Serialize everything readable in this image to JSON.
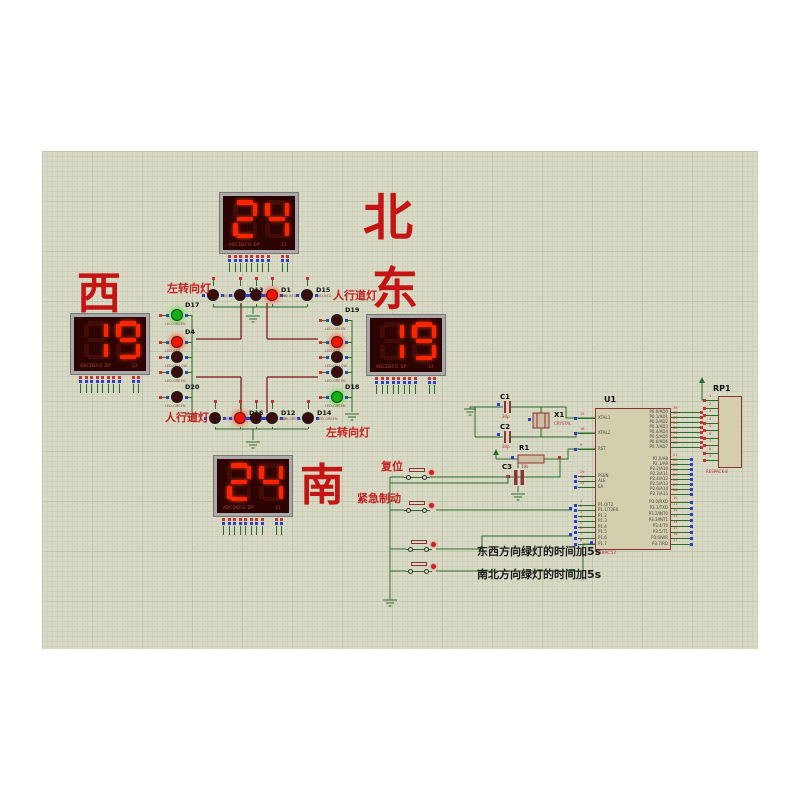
{
  "app": {
    "canvas_bg": "#d9dac6",
    "wire_color": "#2a6e2a",
    "road_color": "#8b3434",
    "accent_red": "#c41414"
  },
  "displays": [
    {
      "name": "north",
      "digits": "24",
      "char": "北",
      "strip_left": "ABCDEFG  DP",
      "strip_right": "12",
      "x": 220,
      "y": 193,
      "char_x": 363,
      "char_y": 193,
      "char_size": 50
    },
    {
      "name": "west",
      "digits": "19",
      "char": "西",
      "strip_left": "ABCDEFG  DP",
      "strip_right": "12",
      "x": 71,
      "y": 314,
      "char_x": 77,
      "char_y": 272,
      "char_size": 44
    },
    {
      "name": "east",
      "digits": "19",
      "char": "东",
      "strip_left": "ABCDEFG  DP",
      "strip_right": "12",
      "x": 367,
      "y": 315,
      "char_x": 372,
      "char_y": 266,
      "char_size": 46
    },
    {
      "name": "south",
      "digits": "24",
      "char": "南",
      "strip_left": "ABCDEFG  DP",
      "strip_right": "12",
      "x": 214,
      "y": 456,
      "char_x": 300,
      "char_y": 464,
      "char_size": 44
    }
  ],
  "led_groups": [
    {
      "name": "west-signals",
      "dir": "col",
      "bus": 192,
      "items": [
        {
          "n": "D17",
          "t": "LED-GREEN",
          "s": "green",
          "x": 177,
          "y": 315
        },
        {
          "n": "D4",
          "t": "LED-RED",
          "s": "red",
          "x": 177,
          "y": 342
        },
        {
          "n": "",
          "t": "LED-YELLOW",
          "s": "off",
          "x": 177,
          "y": 357
        },
        {
          "n": "",
          "t": "LED-GREEN",
          "s": "off",
          "x": 177,
          "y": 372
        },
        {
          "n": "D20",
          "t": "LED-GREEN",
          "s": "off",
          "x": 177,
          "y": 397
        }
      ]
    },
    {
      "name": "east-signals",
      "dir": "col",
      "bus": 352,
      "items": [
        {
          "n": "D19",
          "t": "LED-GREEN",
          "s": "off",
          "x": 337,
          "y": 320
        },
        {
          "n": "",
          "t": "LED-RED",
          "s": "red",
          "x": 337,
          "y": 342
        },
        {
          "n": "",
          "t": "LED-YELLOW",
          "s": "off",
          "x": 337,
          "y": 357
        },
        {
          "n": "",
          "t": "LED-GREEN",
          "s": "off",
          "x": 337,
          "y": 372
        },
        {
          "n": "D18",
          "t": "LED-GREEN",
          "s": "green",
          "x": 337,
          "y": 397
        }
      ]
    },
    {
      "name": "north-signals",
      "dir": "row",
      "bus": 307,
      "items": [
        {
          "n": "",
          "t": "LED-GREEN",
          "s": "off",
          "x": 213,
          "y": 295
        },
        {
          "n": "D13",
          "t": "LED-GREEN",
          "s": "off",
          "x": 240,
          "y": 295
        },
        {
          "n": "",
          "t": "LED-YELLOW",
          "s": "off",
          "x": 256,
          "y": 295
        },
        {
          "n": "D1",
          "t": "LED-RED",
          "s": "red",
          "x": 272,
          "y": 295
        },
        {
          "n": "D15",
          "t": "LED-RED",
          "s": "off",
          "x": 307,
          "y": 295
        }
      ]
    },
    {
      "name": "south-signals",
      "dir": "row",
      "bus": 429,
      "items": [
        {
          "n": "",
          "t": "LED-GREEN",
          "s": "off",
          "x": 215,
          "y": 418
        },
        {
          "n": "D16",
          "t": "LED-RED",
          "s": "red",
          "x": 240,
          "y": 418
        },
        {
          "n": "",
          "t": "LED-YELLOW",
          "s": "off",
          "x": 256,
          "y": 418
        },
        {
          "n": "D12",
          "t": "LED-GREEN",
          "s": "off",
          "x": 272,
          "y": 418
        },
        {
          "n": "D14",
          "t": "LED-GREEN",
          "s": "off",
          "x": 308,
          "y": 418
        }
      ]
    }
  ],
  "labels": [
    {
      "t": "左转向灯",
      "x": 167,
      "y": 283,
      "c": "red"
    },
    {
      "t": "人行道灯",
      "x": 333,
      "y": 290,
      "c": "red"
    },
    {
      "t": "人行道灯",
      "x": 165,
      "y": 412,
      "c": "red"
    },
    {
      "t": "左转向灯",
      "x": 326,
      "y": 427,
      "c": "red"
    },
    {
      "t": "复位",
      "x": 381,
      "y": 461,
      "c": "red"
    },
    {
      "t": "紧急制动",
      "x": 357,
      "y": 493,
      "c": "red"
    },
    {
      "t": "东西方向绿灯的时间加5s",
      "x": 477,
      "y": 546,
      "c": "black"
    },
    {
      "t": "南北方向绿灯的时间加5s",
      "x": 477,
      "y": 569,
      "c": "black"
    }
  ],
  "buttons": [
    {
      "name": "reset-button",
      "x": 404,
      "y": 468
    },
    {
      "name": "emergency-brake-button",
      "x": 404,
      "y": 501
    },
    {
      "name": "ew-green-plus-5s-button",
      "x": 406,
      "y": 540
    },
    {
      "name": "ns-green-plus-5s-button",
      "x": 406,
      "y": 562
    }
  ],
  "mcu": {
    "ref": "U1",
    "part": "AT89C52",
    "left": [
      {
        "no": "19",
        "t": "XTAL1",
        "y": 418
      },
      {
        "no": "18",
        "t": "XTAL2",
        "y": 433
      },
      {
        "no": "9",
        "t": "RST",
        "y": 449
      },
      {
        "no": "29",
        "t": "PSEN",
        "y": 476
      },
      {
        "no": "30",
        "t": "ALE",
        "y": 481
      },
      {
        "no": "31",
        "t": "EA",
        "y": 487
      },
      {
        "no": "1",
        "t": "P1.0/T2",
        "y": 505
      },
      {
        "no": "2",
        "t": "P1.1/T2EX",
        "y": 510
      },
      {
        "no": "3",
        "t": "P1.2",
        "y": 516
      },
      {
        "no": "4",
        "t": "P1.3",
        "y": 521
      },
      {
        "no": "5",
        "t": "P1.4",
        "y": 527
      },
      {
        "no": "6",
        "t": "P1.5",
        "y": 532
      },
      {
        "no": "7",
        "t": "P1.6",
        "y": 538
      },
      {
        "no": "8",
        "t": "P1.7",
        "y": 544
      }
    ],
    "right": [
      {
        "no": "39",
        "t": "P0.0/AD0",
        "y": 412
      },
      {
        "no": "38",
        "t": "P0.1/AD1",
        "y": 417
      },
      {
        "no": "37",
        "t": "P0.2/AD2",
        "y": 422
      },
      {
        "no": "36",
        "t": "P0.3/AD3",
        "y": 427
      },
      {
        "no": "35",
        "t": "P0.4/AD4",
        "y": 432
      },
      {
        "no": "34",
        "t": "P0.5/AD5",
        "y": 437
      },
      {
        "no": "33",
        "t": "P0.6/AD6",
        "y": 442
      },
      {
        "no": "32",
        "t": "P0.7/AD7",
        "y": 447
      },
      {
        "no": "21",
        "t": "P2.0/A8",
        "y": 459
      },
      {
        "no": "22",
        "t": "P2.1/A9",
        "y": 464
      },
      {
        "no": "23",
        "t": "P2.2/A10",
        "y": 469
      },
      {
        "no": "24",
        "t": "P2.3/A11",
        "y": 474
      },
      {
        "no": "25",
        "t": "P2.4/A12",
        "y": 479
      },
      {
        "no": "26",
        "t": "P2.5/A13",
        "y": 484
      },
      {
        "no": "27",
        "t": "P2.6/A14",
        "y": 489
      },
      {
        "no": "28",
        "t": "P2.7/A15",
        "y": 494
      },
      {
        "no": "10",
        "t": "P3.0/RXD",
        "y": 502
      },
      {
        "no": "11",
        "t": "P3.1/TXD",
        "y": 508
      },
      {
        "no": "12",
        "t": "P3.2/INT0",
        "y": 514
      },
      {
        "no": "13",
        "t": "P3.3/INT1",
        "y": 520
      },
      {
        "no": "14",
        "t": "P3.4/T0",
        "y": 526
      },
      {
        "no": "15",
        "t": "P3.5/T1",
        "y": 532
      },
      {
        "no": "16",
        "t": "P3.6/WR",
        "y": 538
      },
      {
        "no": "17",
        "t": "P3.7/RD",
        "y": 544
      }
    ]
  },
  "rp1": {
    "ref": "RP1",
    "part": "RESPACK-8",
    "pins": [
      "1",
      "2",
      "3",
      "4",
      "5",
      "6",
      "7",
      "8",
      "9"
    ]
  },
  "parts": {
    "c1": {
      "ref": "C1",
      "val": "30p"
    },
    "c2": {
      "ref": "C2",
      "val": "30p"
    },
    "x1": {
      "ref": "X1",
      "val": "CRYSTAL"
    },
    "r1": {
      "ref": "R1",
      "val": "10k"
    },
    "c3": {
      "ref": "C3",
      "val": ""
    }
  }
}
